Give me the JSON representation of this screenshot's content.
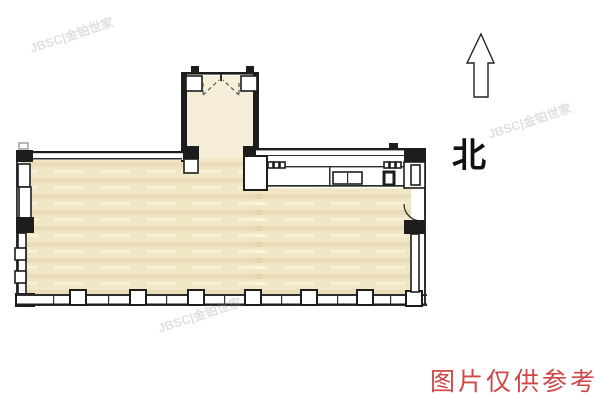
{
  "colors": {
    "floor": "#f1e7c6",
    "floor-light": "#f6eed8",
    "wall": "#1d1d1d",
    "line": "#2e2e2e",
    "accent-red": "#cf4747",
    "watermark": "#8f8f8f"
  },
  "compass": {
    "north_label": "北",
    "north_arrow_icon": "north-arrow"
  },
  "disclaimer": {
    "text": "图片仅供参考"
  },
  "watermark": {
    "text": "JBSC|金铂世家"
  }
}
